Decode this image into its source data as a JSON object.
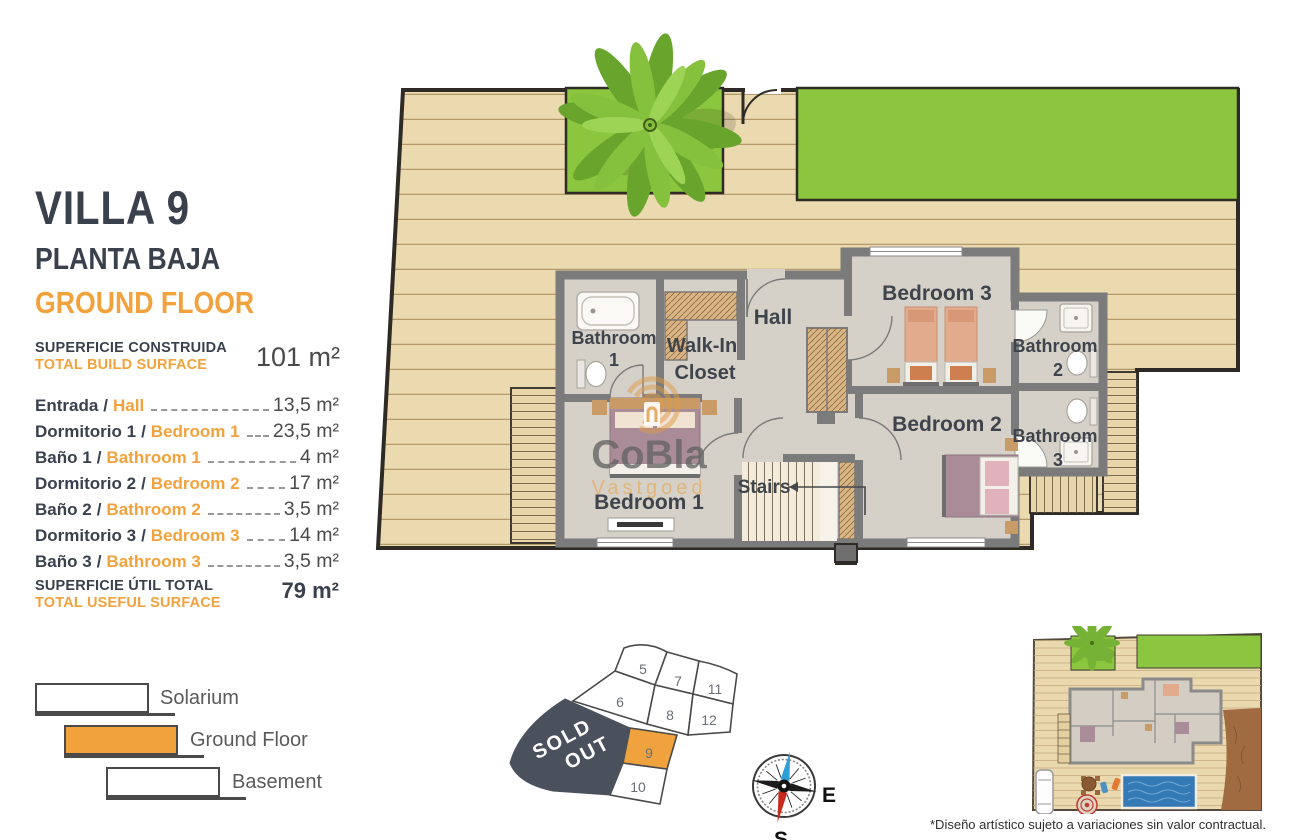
{
  "header": {
    "villa": "VILLA 9",
    "floor_es": "PLANTA BAJA",
    "floor_en": "GROUND FLOOR"
  },
  "build": {
    "label_es": "SUPERFICIE CONSTRUIDA",
    "label_en": "TOTAL BUILD SURFACE",
    "value": "101 m²"
  },
  "sep": "/",
  "rooms": [
    {
      "es": "Entrada",
      "en": "Hall",
      "value": "13,5 m²"
    },
    {
      "es": "Dormitorio 1",
      "en": "Bedroom 1",
      "value": "23,5 m²"
    },
    {
      "es": "Baño 1",
      "en": "Bathroom 1",
      "value": "4 m²"
    },
    {
      "es": "Dormitorio 2",
      "en": "Bedroom 2",
      "value": "17 m²"
    },
    {
      "es": "Baño 2",
      "en": "Bathroom 2",
      "value": "3,5 m²"
    },
    {
      "es": "Dormitorio 3",
      "en": "Bedroom 3",
      "value": "14 m²"
    },
    {
      "es": "Baño 3",
      "en": "Bathroom 3",
      "value": "3,5 m²"
    }
  ],
  "useful": {
    "label_es": "SUPERFICIE ÚTIL TOTAL",
    "label_en": "TOTAL USEFUL SURFACE",
    "value": "79 m²"
  },
  "legend": {
    "items": [
      {
        "label": "Solarium"
      },
      {
        "label": "Ground Floor"
      },
      {
        "label": "Basement"
      }
    ]
  },
  "plan": {
    "labels": {
      "hall": "Hall",
      "walkin_l1": "Walk-In",
      "walkin_l2": "Closet",
      "bath1_l1": "Bathroom",
      "bath1_l2": "1",
      "bath2_l1": "Bathroom",
      "bath2_l2": "2",
      "bath3_l1": "Bathroom",
      "bath3_l2": "3",
      "bed1": "Bedroom 1",
      "bed2": "Bedroom 2",
      "bed3": "Bedroom 3",
      "stairs": "Stairs"
    },
    "watermark": {
      "line1": "CoBla",
      "line2": "Vastgoed"
    }
  },
  "site_map": {
    "sold_l1": "SOLD",
    "sold_l2": "OUT",
    "highlighted_plot": "9",
    "plots": {
      "p5": "5",
      "p6": "6",
      "p7": "7",
      "p8": "8",
      "p11": "11",
      "p12": "12",
      "p9": "9",
      "p10": "10"
    }
  },
  "compass": {
    "e": "E",
    "s": "S"
  },
  "disclaimer": "*Diseño artístico sujeto a variaciones sin valor contractual.",
  "colors": {
    "accent_orange": "#F2A23C",
    "dark_text": "#3A414D",
    "grass_green": "#8CC63E",
    "deck_tan": "#EBD9AF",
    "wall_gray": "#7B7B7B",
    "sold_out_gray": "#4A505C"
  }
}
